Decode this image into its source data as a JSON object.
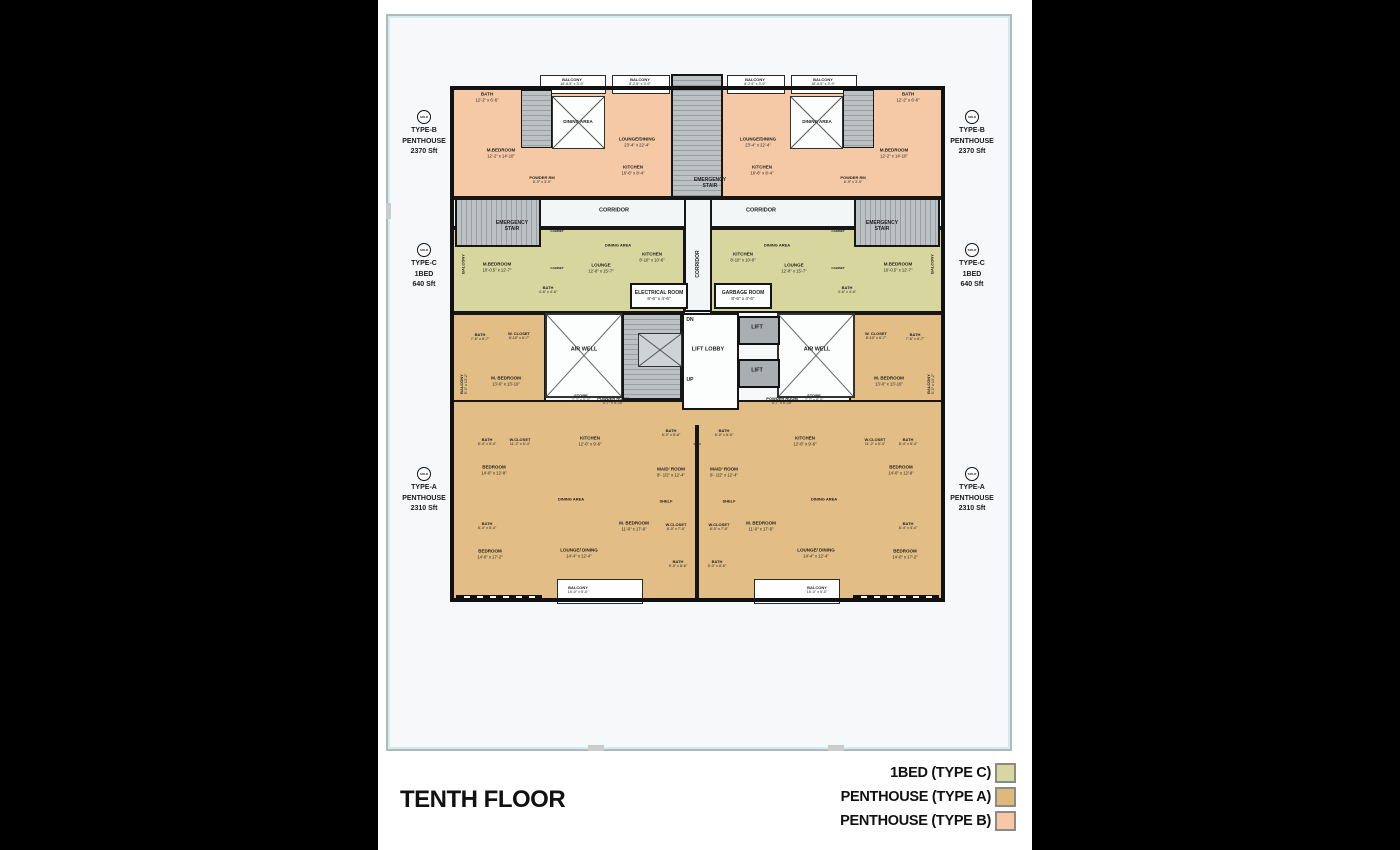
{
  "page": {
    "title": "TENTH FLOOR"
  },
  "colors": {
    "type_b": "#f5c9a5",
    "type_c": "#d8d69f",
    "type_a": "#e2bd85"
  },
  "legend": {
    "items": [
      {
        "label": "1BED (TYPE C)",
        "color": "#d9d7a0"
      },
      {
        "label": "PENTHOUSE (TYPE A)",
        "color": "#ddb97c"
      },
      {
        "label": "PENTHOUSE (TYPE B)",
        "color": "#f6c9a4"
      }
    ]
  },
  "unit_labels": {
    "left": [
      {
        "badge": "SOLD",
        "type": "TYPE-B",
        "name": "PENTHOUSE",
        "area": "2370 Sft"
      },
      {
        "badge": "SOLD",
        "type": "TYPE-C",
        "name": "1BED",
        "area": "640 Sft"
      },
      {
        "badge": "SOLD",
        "type": "TYPE-A",
        "name": "PENTHOUSE",
        "area": "2310 Sft"
      }
    ],
    "right": [
      {
        "badge": "SOLD",
        "type": "TYPE-B",
        "name": "PENTHOUSE",
        "area": "2370 Sft"
      },
      {
        "badge": "SOLD",
        "type": "TYPE-C",
        "name": "1BED",
        "area": "640 Sft"
      },
      {
        "badge": "SOLD",
        "type": "TYPE-A",
        "name": "PENTHOUSE",
        "area": "2310 Sft"
      }
    ]
  },
  "rooms": [
    {
      "l": "BATH",
      "d": "12'-2\" x 6'-6\"",
      "x": 487,
      "y": 97
    },
    {
      "l": "BATH",
      "d": "12'-2\" x 6'-6\"",
      "x": 908,
      "y": 97
    },
    {
      "l": "BALCONY",
      "d": "18'-6.5\" x 3'-9\"",
      "x": 572,
      "y": 82,
      "s": 4
    },
    {
      "l": "BALCONY",
      "d": "8'-2.5\" x 3'-9\"",
      "x": 640,
      "y": 82,
      "s": 4
    },
    {
      "l": "BALCONY",
      "d": "8'-2.5\" x 3'-9\"",
      "x": 755,
      "y": 82,
      "s": 4
    },
    {
      "l": "BALCONY",
      "d": "18'-6.5\" x 3'-9\"",
      "x": 823,
      "y": 82,
      "s": 4
    },
    {
      "l": "DINING AREA",
      "x": 578,
      "y": 122
    },
    {
      "l": "DINING AREA",
      "x": 817,
      "y": 122
    },
    {
      "l": "LOUNGE/DINING",
      "d": "23'-4\" x 22'-4\"",
      "x": 637,
      "y": 142
    },
    {
      "l": "LOUNGE/DINING",
      "d": "23'-4\" x 22'-4\"",
      "x": 758,
      "y": 142
    },
    {
      "l": "KITCHEN",
      "d": "16'-6\" x 8'-4\"",
      "x": 633,
      "y": 170
    },
    {
      "l": "KITCHEN",
      "d": "16'-6\" x 8'-4\"",
      "x": 762,
      "y": 170
    },
    {
      "l": "M.BEDROOM",
      "d": "12'-2\" x 14'-10\"",
      "x": 501,
      "y": 153
    },
    {
      "l": "M.BEDROOM",
      "d": "12'-2\" x 14'-10\"",
      "x": 894,
      "y": 153
    },
    {
      "l": "POWDER RM",
      "d": "6'-9\" x 3'-9\"",
      "x": 542,
      "y": 180,
      "s": 4
    },
    {
      "l": "POWDER RM",
      "d": "6'-9\" x 3'-9\"",
      "x": 853,
      "y": 180,
      "s": 4
    },
    {
      "l": "EMERGENCY STAIR",
      "x": 710,
      "y": 183,
      "s": 5,
      "w": 36
    },
    {
      "l": "CORRIDOR",
      "x": 614,
      "y": 211,
      "s": 5.5
    },
    {
      "l": "CORRIDOR",
      "x": 761,
      "y": 211,
      "s": 5.5
    },
    {
      "l": "EMERGENCY STAIR",
      "x": 512,
      "y": 226,
      "s": 5,
      "w": 36
    },
    {
      "l": "EMERGENCY STAIR",
      "x": 882,
      "y": 226,
      "s": 5,
      "w": 36
    },
    {
      "l": "CORRIDOR",
      "x": 698,
      "y": 264,
      "s": 5,
      "r": -90
    },
    {
      "l": "M.BEDROOM",
      "d": "10'-0.5\" x 12'-7\"",
      "x": 497,
      "y": 267
    },
    {
      "l": "M.BEDROOM",
      "d": "10'-0.5\" x 12'-7\"",
      "x": 898,
      "y": 267
    },
    {
      "l": "BALCONY",
      "x": 463,
      "y": 264,
      "r": -90,
      "s": 4
    },
    {
      "l": "BALCONY",
      "x": 932,
      "y": 264,
      "r": -90,
      "s": 4
    },
    {
      "l": "BATH",
      "d": "4'-6\" x 4'-6\"",
      "x": 548,
      "y": 290,
      "s": 4
    },
    {
      "l": "BATH",
      "d": "4'-6\" x 4'-6\"",
      "x": 847,
      "y": 290,
      "s": 4
    },
    {
      "l": "LOUNGE",
      "d": "12'-8\" x 15'-7\"",
      "x": 601,
      "y": 268
    },
    {
      "l": "LOUNGE",
      "d": "12'-8\" x 15'-7\"",
      "x": 794,
      "y": 268
    },
    {
      "l": "DINING AREA",
      "x": 618,
      "y": 245,
      "s": 4
    },
    {
      "l": "DINING AREA",
      "x": 777,
      "y": 245,
      "s": 4
    },
    {
      "l": "KITCHEN",
      "d": "8'-10\" x 10'-6\"",
      "x": 652,
      "y": 257
    },
    {
      "l": "KITCHEN",
      "d": "8'-10\" x 10'-6\"",
      "x": 743,
      "y": 257
    },
    {
      "l": "CABINET",
      "x": 557,
      "y": 232,
      "s": 3
    },
    {
      "l": "CABINET",
      "x": 557,
      "y": 269,
      "s": 3
    },
    {
      "l": "CABINET",
      "x": 838,
      "y": 232,
      "s": 3
    },
    {
      "l": "CABINET",
      "x": 838,
      "y": 269,
      "s": 3
    },
    {
      "l": "ELECTRICAL ROOM",
      "d": "8'-6\" x 4'-6\"",
      "x": 659,
      "y": 296,
      "s": 5
    },
    {
      "l": "GARBAGE ROOM",
      "d": "8'-6\" x 4'-6\"",
      "x": 743,
      "y": 296,
      "s": 5
    },
    {
      "l": "BATH",
      "d": "7'-6\" x 6'-7\"",
      "x": 480,
      "y": 337,
      "s": 4
    },
    {
      "l": "BATH",
      "d": "7'-6\" x 6'-7\"",
      "x": 915,
      "y": 337,
      "s": 4
    },
    {
      "l": "W. CLOSET",
      "d": "8'-10\" x 6'-7\"",
      "x": 519,
      "y": 336,
      "s": 4
    },
    {
      "l": "W. CLOSET",
      "d": "8'-10\" x 6'-7\"",
      "x": 876,
      "y": 336,
      "s": 4
    },
    {
      "l": "M. BEDROOM",
      "d": "13'-0\" x 13'-10\"",
      "x": 506,
      "y": 381
    },
    {
      "l": "M. BEDROOM",
      "d": "13'-0\" x 13'-10\"",
      "x": 889,
      "y": 381
    },
    {
      "l": "BALCONY",
      "d": "5'-0\" x 13'-2\"",
      "x": 464,
      "y": 384,
      "r": -90,
      "s": 4
    },
    {
      "l": "BALCONY",
      "d": "5'-0\" x 13'-2\"",
      "x": 931,
      "y": 384,
      "r": -90,
      "s": 4
    },
    {
      "l": "AIR WELL",
      "x": 584,
      "y": 350,
      "s": 5.5
    },
    {
      "l": "AIR WELL",
      "x": 817,
      "y": 350,
      "s": 5.5
    },
    {
      "l": "DN",
      "x": 690,
      "y": 320,
      "s": 5
    },
    {
      "l": "LIFT LOBBY",
      "x": 708,
      "y": 350,
      "s": 5.5
    },
    {
      "l": "UP",
      "x": 690,
      "y": 380,
      "s": 5
    },
    {
      "l": "LIFT",
      "x": 757,
      "y": 328,
      "s": 5.5
    },
    {
      "l": "LIFT",
      "x": 757,
      "y": 371,
      "s": 5.5
    },
    {
      "l": "STORE",
      "d": "7'-7\" x 5'-0\"",
      "x": 581,
      "y": 398,
      "s": 4
    },
    {
      "l": "STORE",
      "d": "7'-7\" x 5'-0\"",
      "x": 814,
      "y": 398,
      "s": 4
    },
    {
      "l": "POWDER ROOM",
      "d": "4'-7\" x 5'-10\"",
      "x": 613,
      "y": 401,
      "s": 4
    },
    {
      "l": "POWDER ROOM",
      "d": "4'-7\" x 5'-10\"",
      "x": 782,
      "y": 401,
      "s": 4
    },
    {
      "l": "KITCHEN",
      "d": "12'-6\" x 9'-6\"",
      "x": 590,
      "y": 441
    },
    {
      "l": "KITCHEN",
      "d": "12'-6\" x 9'-6\"",
      "x": 805,
      "y": 441
    },
    {
      "l": "BATH",
      "d": "8'-4\" x 5'-4\"",
      "x": 487,
      "y": 442,
      "s": 4
    },
    {
      "l": "BATH",
      "d": "8'-4\" x 5'-4\"",
      "x": 908,
      "y": 442,
      "s": 4
    },
    {
      "l": "W.CLOSET",
      "d": "11'-2\" x 5'-4\"",
      "x": 520,
      "y": 442,
      "s": 4
    },
    {
      "l": "W.CLOSET",
      "d": "11'-2\" x 5'-4\"",
      "x": 875,
      "y": 442,
      "s": 4
    },
    {
      "l": "BEDROOM",
      "d": "14'-0\" x 12'-8\"",
      "x": 494,
      "y": 470
    },
    {
      "l": "BEDROOM",
      "d": "14'-0\" x 12'-8\"",
      "x": 901,
      "y": 470
    },
    {
      "l": "BATH",
      "d": "8'-4\" x 5'-4\"",
      "x": 487,
      "y": 526,
      "s": 4
    },
    {
      "l": "BATH",
      "d": "8'-4\" x 5'-4\"",
      "x": 908,
      "y": 526,
      "s": 4
    },
    {
      "l": "BEDROOM",
      "d": "14'-0\" x 17'-2\"",
      "x": 490,
      "y": 554
    },
    {
      "l": "BEDROOM",
      "d": "14'-0\" x 17'-2\"",
      "x": 905,
      "y": 554
    },
    {
      "l": "DINING AREA",
      "x": 571,
      "y": 499,
      "s": 4
    },
    {
      "l": "DINING AREA",
      "x": 824,
      "y": 499,
      "s": 4
    },
    {
      "l": "LOUNGE/ DINING",
      "d": "14'-4\" x 12'-4\"",
      "x": 579,
      "y": 553
    },
    {
      "l": "LOUNGE/ DINING",
      "d": "14'-4\" x 12'-4\"",
      "x": 816,
      "y": 553
    },
    {
      "l": "BALCONY",
      "d": "15'-0\" x 5'-0\"",
      "x": 578,
      "y": 590,
      "s": 4
    },
    {
      "l": "BALCONY",
      "d": "15'-0\" x 5'-0\"",
      "x": 817,
      "y": 590,
      "s": 4
    },
    {
      "l": "M. BEDROOM",
      "d": "11'-0\" x 17'-6\"",
      "x": 634,
      "y": 526
    },
    {
      "l": "M. BEDROOM",
      "d": "11'-0\" x 17'-6\"",
      "x": 761,
      "y": 526
    },
    {
      "l": "W.CLOSET",
      "d": "8'-0\" x 7'-0\"",
      "x": 676,
      "y": 527,
      "s": 4
    },
    {
      "l": "W.CLOSET",
      "d": "8'-0\" x 7'-0\"",
      "x": 719,
      "y": 527,
      "s": 4
    },
    {
      "l": "BATH",
      "d": "5'-0\" x 8'-6\"",
      "x": 678,
      "y": 564,
      "s": 4
    },
    {
      "l": "BATH",
      "d": "5'-0\" x 8'-6\"",
      "x": 717,
      "y": 564,
      "s": 4
    },
    {
      "l": "BATH",
      "d": "6'-0\" x 5'-6\"",
      "x": 671,
      "y": 433,
      "s": 4
    },
    {
      "l": "BATH",
      "d": "6'-0\" x 5'-6\"",
      "x": 724,
      "y": 433,
      "s": 4
    },
    {
      "l": "VOID",
      "x": 697,
      "y": 445,
      "s": 3
    },
    {
      "l": "MAID' ROOM",
      "d": "8'- 1/2\" x 12'-4\"",
      "x": 671,
      "y": 472
    },
    {
      "l": "MAID' ROOM",
      "d": "8'- 1/2\" x 12'-4\"",
      "x": 724,
      "y": 472
    },
    {
      "l": "SHELF",
      "x": 666,
      "y": 501,
      "s": 4
    },
    {
      "l": "SHELF",
      "x": 729,
      "y": 501,
      "s": 4
    }
  ]
}
